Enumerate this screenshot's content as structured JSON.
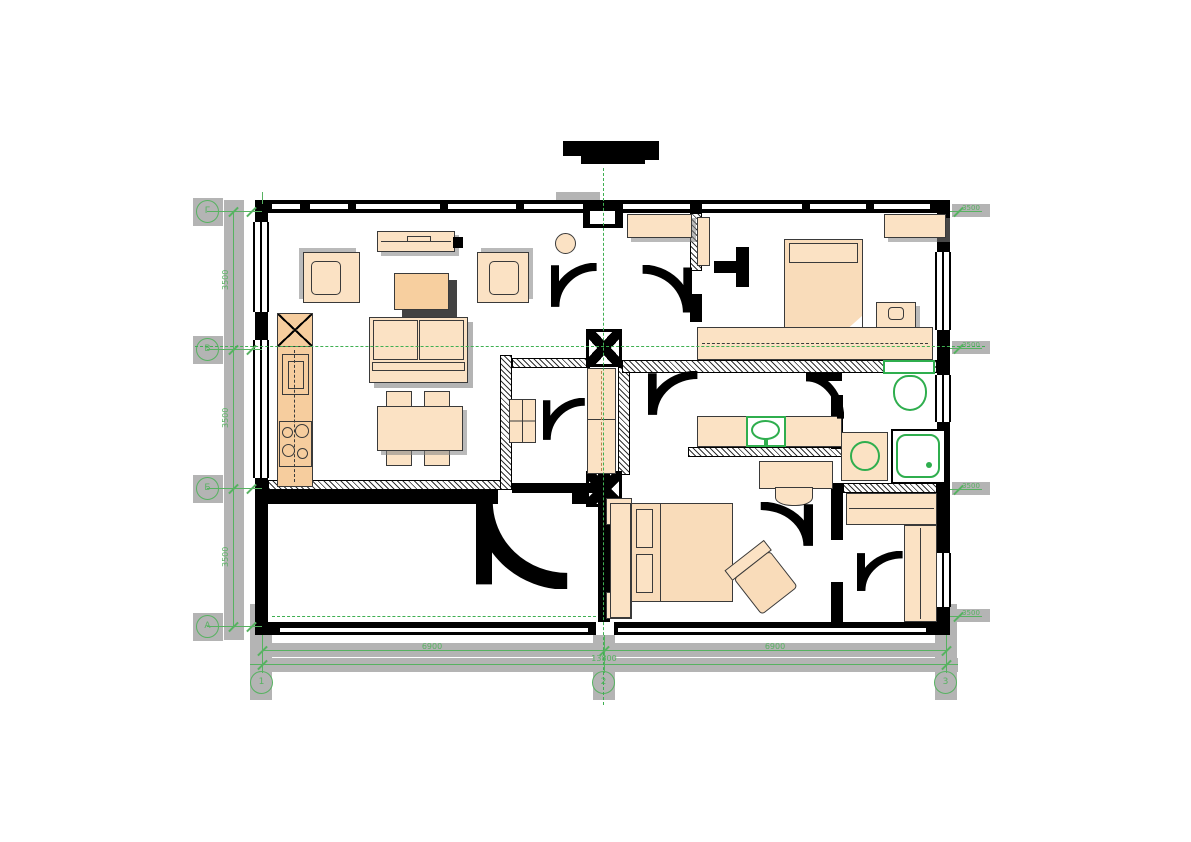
{
  "drawing": {
    "kind": "apartment-floor-plan",
    "colors": {
      "dimension_green": "#57b261",
      "sanitary_green": "#2fae4e",
      "furniture_fill": "#fbe2c4",
      "kitchen_fill": "#f6cd9e",
      "wall_black": "#000000",
      "highlight_gray": "#b4b4b4"
    }
  },
  "grid": {
    "rows": [
      {
        "label": "Г"
      },
      {
        "label": "В"
      },
      {
        "label": "Б"
      },
      {
        "label": "А"
      }
    ],
    "cols": [
      {
        "label": "1"
      },
      {
        "label": "2"
      },
      {
        "label": "3"
      }
    ]
  },
  "dimensions": {
    "left": [
      {
        "value": "3500"
      },
      {
        "value": "3500"
      },
      {
        "value": "3500"
      }
    ],
    "bottom_segments": [
      {
        "value": "6900"
      },
      {
        "value": "6900"
      }
    ],
    "bottom_total": "13800",
    "right_marks": [
      {
        "value": "3500"
      },
      {
        "value": "3500"
      },
      {
        "value": "3500"
      },
      {
        "value": "3500"
      }
    ]
  }
}
